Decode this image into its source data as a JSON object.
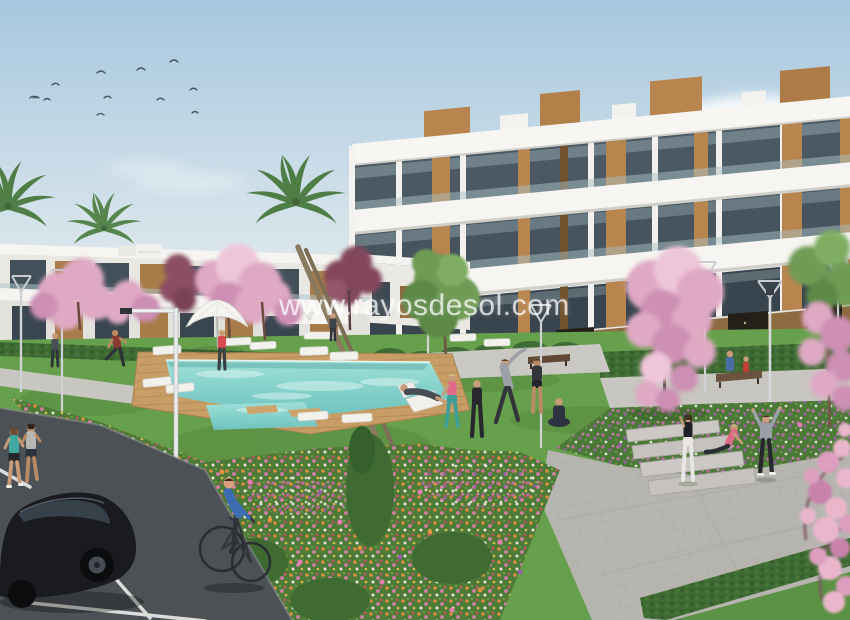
{
  "watermark": {
    "text": "www.rayosdesol.com"
  },
  "scene": {
    "subject": "New-build residential apartment complex with communal pool, landscaped gardens and parking",
    "style": "3D architectural exterior render",
    "colors": {
      "sky_top": "#a6c7df",
      "sky_bottom": "#e9eef0",
      "building_white": "#f6f5f1",
      "building_shadow": "#e2e1dc",
      "glass": "#46545d",
      "wood": "#b8854e",
      "storefront_wood": "#8d6a40",
      "lawn": "#67a04c",
      "hedge": "#3e6b33",
      "pool_water": "#86d0cb",
      "deck_wood": "#c89e66",
      "path_gray": "#c8c6c0",
      "plaza_gray": "#b7b5b0",
      "asphalt": "#4c5156",
      "blossom_pink": "#dfa9c4",
      "maroon_tree": "#82465c",
      "palm_green": "#4e7d46",
      "flower_orange": "#e2913f",
      "flower_pink": "#e07fb0",
      "flower_purple": "#9a5fa8",
      "car_black": "#1a1b1f"
    },
    "elements": {
      "birds": 11,
      "palm_trees": 4,
      "blossom_trees": 6,
      "street_lamps": 8,
      "sun_loungers": 11,
      "parasols": 1,
      "benches": 2,
      "people": 19,
      "cars": 1,
      "bicycles": 1,
      "pools": 1,
      "apartment_buildings": 2
    }
  }
}
